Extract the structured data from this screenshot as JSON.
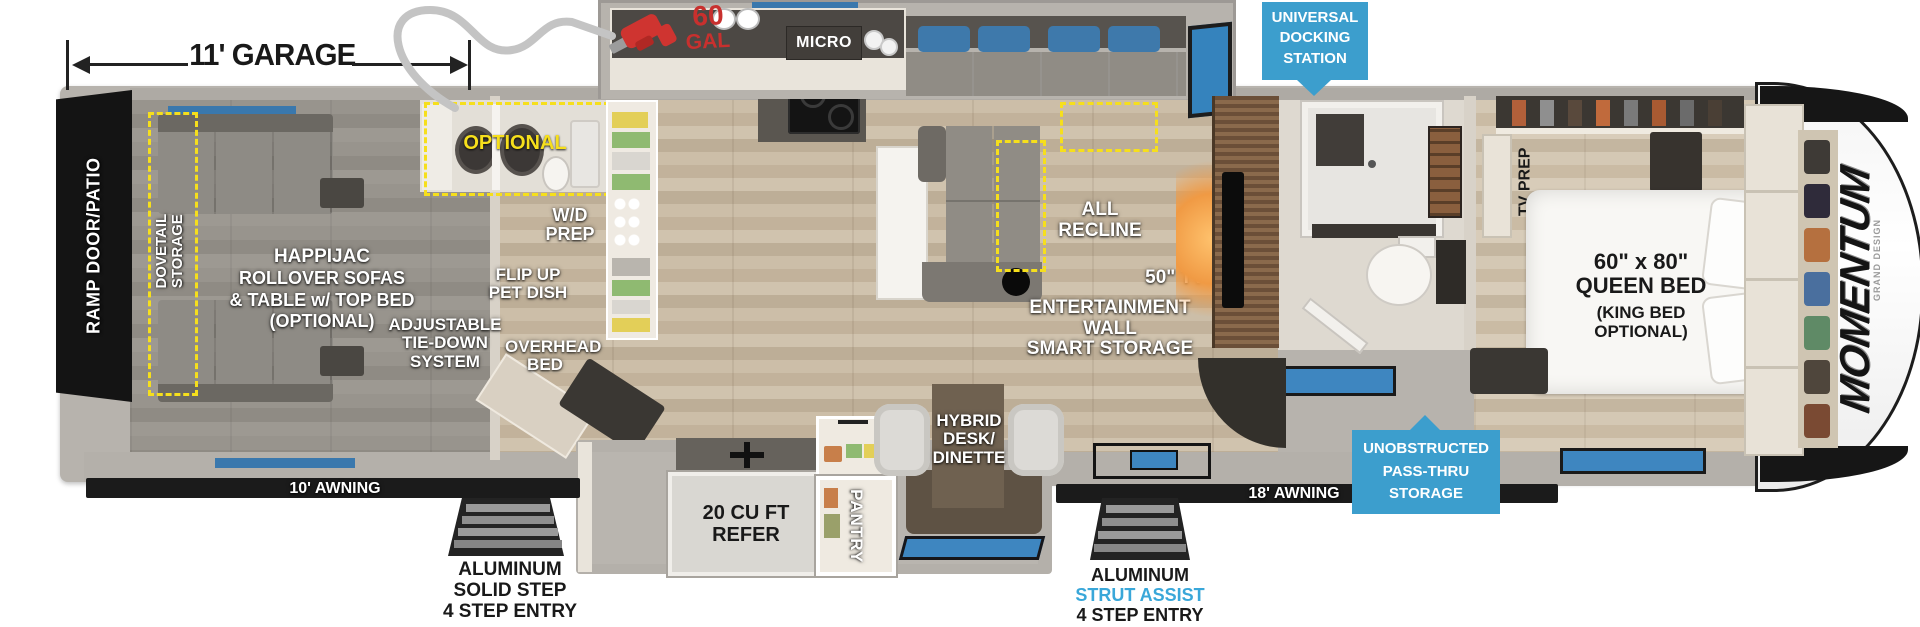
{
  "garage_dim": {
    "label": "11' GARAGE"
  },
  "fuel": {
    "qty": "60",
    "unit": "GAL"
  },
  "badges": {
    "docking": {
      "lines": [
        "UNIVERSAL",
        "DOCKING",
        "STATION"
      ]
    },
    "passthru": {
      "lines": [
        "UNOBSTRUCTED",
        "PASS-THRU",
        "STORAGE"
      ]
    }
  },
  "awnings": {
    "left": "10' AWNING",
    "right": "18' AWNING"
  },
  "steps": {
    "left": {
      "lines": [
        "ALUMINUM",
        "SOLID STEP",
        "4 STEP ENTRY"
      ]
    },
    "right": {
      "lines": [
        "ALUMINUM",
        "STRUT ASSIST",
        "4 STEP ENTRY"
      ]
    }
  },
  "garage": {
    "ramp_door": "RAMP DOOR/PATIO",
    "dovetail": {
      "lines": [
        "DOVETAIL",
        "STORAGE"
      ]
    },
    "happijac": {
      "lines": [
        "HAPPIJAC",
        "ROLLOVER SOFAS",
        "& TABLE w/ TOP BED",
        "(OPTIONAL)"
      ]
    },
    "tie_down": {
      "lines": [
        "ADJUSTABLE",
        "TIE-DOWN",
        "SYSTEM"
      ]
    },
    "overhead_bed": {
      "lines": [
        "OVERHEAD",
        "BED"
      ]
    }
  },
  "bath_wd": {
    "optional": "OPTIONAL",
    "wd_prep": {
      "lines": [
        "W/D",
        "PREP"
      ]
    },
    "flip_up": {
      "lines": [
        "FLIP UP",
        "PET DISH"
      ]
    }
  },
  "kitchen": {
    "micro": "MICRO",
    "refer": {
      "lines": [
        "20 CU FT",
        "REFER"
      ]
    },
    "pantry": "PANTRY"
  },
  "living": {
    "all_recline": "ALL RECLINE",
    "tv": "50\" TV",
    "ent_wall": {
      "lines": [
        "ENTERTAINMENT WALL",
        "SMART STORAGE"
      ]
    },
    "hybrid": {
      "lines": [
        "HYBRID",
        "DESK/",
        "DINETTE"
      ]
    }
  },
  "bedroom": {
    "tv_prep": "TV PREP",
    "bed": {
      "lines": [
        "60\" x 80\"",
        "QUEEN BED",
        "(KING BED",
        "OPTIONAL)"
      ]
    }
  },
  "brand": {
    "name": "MOMENTUM",
    "maker": "GRAND DESIGN"
  },
  "colors": {
    "badge_blue": "#3c9ecd",
    "strut_blue": "#39a7d9",
    "dash_yellow": "#f6df1c",
    "fuel_red": "#c8302e",
    "window_blue": "#3e86c0"
  }
}
